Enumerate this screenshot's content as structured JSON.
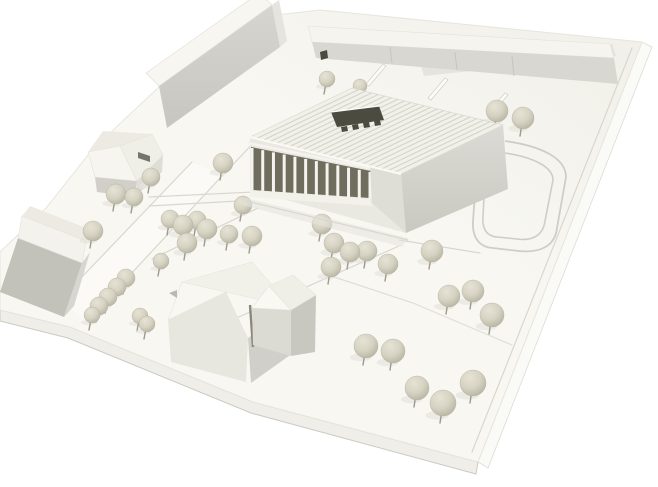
{
  "meta": {
    "title": "Architectural site model photograph",
    "description": "Monochrome white cardboard architecture model viewed from above: central exhibition hall with ribbed roof, dark roof opening and front colonnade, long slab building and row buildings behind, small pitched-roof houses at left and foreground, spherical trees on pins, engraved roads and a looping drive on a tilted white base plate.",
    "type": "photograph",
    "text_in_image": ""
  },
  "palette": {
    "bg": "#ffffff",
    "base_a": "#f8f7f2",
    "base_b": "#f0efe8",
    "base_side": "#efeee8",
    "base_side_dark": "#cbcac3",
    "base_side_bright": "#fafaf6",
    "edge_line": "#dddcd4",
    "engraved": "#d8d7cf",
    "road_fill": "#fbfaf6",
    "roof_white": "#f1f0e9",
    "rib_gap": "#d5d4ca",
    "eave_hi": "#fbfaf5",
    "wall_light": "#e9e8e1",
    "wall_mid": "#deddd6",
    "wall_grey": "#d0cfc9",
    "wall_dark": "#c2c1ba",
    "interior_dark": "#6f6d5e",
    "opening_dark": "#4c4b40",
    "gap_dark": "#8a887b",
    "col": "#f4f3ed",
    "strip_front": "#d8d7d1",
    "tree_hi": "#e6e3d6",
    "tree_main": "#d6d3c3",
    "tree_dk": "#b7b4a2",
    "tree_stick": "#9e9b8d",
    "shadow": "#e5e4dc"
  },
  "scene": {
    "base": {
      "top": "0,252 46,208 92,150 160,86 250,18 320,10 642,42 478,462 253,402 70,327 0,310",
      "side_sw": "0,310 70,327 253,402 478,462 476,474 251,413 68,338 0,321",
      "side_se": "478,462 642,42 652,47 488,468",
      "bevel_se": "632,48 472,452",
      "ne_band": "420,62 612,44 616,56 424,76"
    },
    "roads": {
      "r1_fill": "58,302 192,162 222,176 88,320",
      "r1_edge_a": "58,302 192,162",
      "r1_edge_b": "88,320 222,176",
      "r1_ext": "222,176 262,134",
      "l1": "149,197 296,190",
      "l2": "149,206 238,201",
      "l3": "207,331 399,246",
      "l4": "152,259 258,208",
      "l6": "331,276 413,303 512,345",
      "l7": "399,240 480,253",
      "loop_outer": "M 505,141 C 541,146 566,158 566,177 L 557,228 C 555,247 539,253 519,251 L 493,248 C 478,247 472,236 473,221 L 475,194",
      "loop_inner": "M 505,153 C 531,157 553,166 553,180 L 545,221 C 543,236 532,241 517,239 L 497,237 C 486,236 482,228 483,216 L 484,197"
    },
    "strip": {
      "top": "308,26 610,44 614,58 312,42",
      "front": "312,42 614,58 618,84 316,58",
      "notch": "320,52 327,50 328,58 321,60",
      "seam1": "390,47 392,63",
      "seam2": "455,52 457,70",
      "seam3": "512,56 514,76",
      "fin1": "383,64 366,84 369,86 386,66",
      "fin2": "445,78 428,98 431,100 448,80",
      "fin3": "505,93 489,111 492,113 508,95"
    },
    "bar": {
      "roof": "159,86 272,5 259,-7 146,73",
      "front": "159,86 272,5 280,47 167,128",
      "end": "272,5 280,47 287,41 279,0"
    },
    "hipped_house": {
      "plane1": "88,152 120,146 137,181 95,177",
      "plane2": "120,146 152,134 163,155 137,181",
      "plane3": "103,131 152,134 120,146 88,152",
      "slot": "138,152 150,156 150,162 138,158",
      "wall_front": "95,177 137,181 135,197 97,192",
      "wall_right": "137,181 163,155 162,172 136,196"
    },
    "left_house": {
      "roof": "22,216 86,241 82,263 18,238",
      "ridge_plane": "30,206 94,231 86,241 22,216",
      "wall": "18,238 82,263 64,317 0,292",
      "wall2": "82,263 90,252 74,306 64,317"
    },
    "central": {
      "roof": {
        "outline": "250,137 352,88 503,125 401,174",
        "W": [
          250,
          137
        ],
        "N": [
          352,
          88
        ],
        "E": [
          503,
          125
        ],
        "S": [
          401,
          174
        ],
        "rib_count": 23,
        "eave": "250,137 401,174"
      },
      "skylight": "331,112 379,106 384,120 337,127",
      "skylight_hi": "331,112 379,106",
      "teeth": [
        "341,127 347,126 348,131 342,132",
        "352,125 358,124 359,129 353,130",
        "363,123 369,122 370,127 364,128",
        "374,121 380,120 381,125 375,126"
      ],
      "right_face": "401,174 503,125 508,189 406,233",
      "facade_zone": "250,137 401,174 406,233 250,190",
      "interior": "251,147 371,171 370,198 252,190",
      "beam": "248,143 374,169",
      "wall_right_part": "370,166 401,174 406,233 372,203",
      "plinth": "250,190 370,199 372,206 250,197",
      "apron": "246,201 408,240",
      "shadow": "246,198 408,238 402,247 242,205",
      "colonnade": {
        "count": 12,
        "top": [
          [
            252,
            148
          ],
          [
            370,
            172
          ]
        ],
        "bottom": [
          [
            252,
            190
          ],
          [
            370,
            199
          ]
        ]
      }
    },
    "gable_house": {
      "hip": "182,282 168,320 226,292",
      "roof_main": "182,282 252,262 291,307 226,292",
      "wall_left": "168,320 226,292 248,338 246,382 171,362",
      "wall_right": "248,338 291,307 293,353 251,383",
      "g_tri": "252,308 269,286 291,310",
      "g_roof": "269,286 293,275 316,295 291,310",
      "g_wall_r": "291,310 316,295 315,352 291,356",
      "g_wall_f": "252,308 291,310 291,356 253,345",
      "gap": "250,305 253,347",
      "marker": "169,293 177,290 177,298"
    },
    "trees": [
      [
        327,
        79,
        8
      ],
      [
        360,
        86,
        7
      ],
      [
        497,
        111,
        11
      ],
      [
        523,
        118,
        11
      ],
      [
        223,
        163,
        10
      ],
      [
        243,
        205,
        9
      ],
      [
        116,
        194,
        10
      ],
      [
        134,
        197,
        9
      ],
      [
        151,
        177,
        9
      ],
      [
        93,
        231,
        10
      ],
      [
        170,
        219,
        9
      ],
      [
        183,
        225,
        10
      ],
      [
        197,
        220,
        9
      ],
      [
        207,
        229,
        10
      ],
      [
        187,
        243,
        10
      ],
      [
        229,
        234,
        9
      ],
      [
        252,
        236,
        10
      ],
      [
        322,
        224,
        10
      ],
      [
        334,
        243,
        10
      ],
      [
        350,
        252,
        10
      ],
      [
        367,
        251,
        10
      ],
      [
        388,
        264,
        10
      ],
      [
        331,
        267,
        10
      ],
      [
        432,
        251,
        11
      ],
      [
        449,
        296,
        11
      ],
      [
        473,
        291,
        11
      ],
      [
        492,
        315,
        12
      ],
      [
        366,
        346,
        12
      ],
      [
        393,
        351,
        12
      ],
      [
        417,
        388,
        12
      ],
      [
        443,
        403,
        13
      ],
      [
        473,
        383,
        13
      ],
      [
        126,
        278,
        9
      ],
      [
        117,
        287,
        9
      ],
      [
        108,
        297,
        9
      ],
      [
        99,
        306,
        9
      ],
      [
        92,
        315,
        8
      ],
      [
        140,
        316,
        8
      ],
      [
        147,
        324,
        8
      ],
      [
        161,
        261,
        8
      ]
    ]
  }
}
